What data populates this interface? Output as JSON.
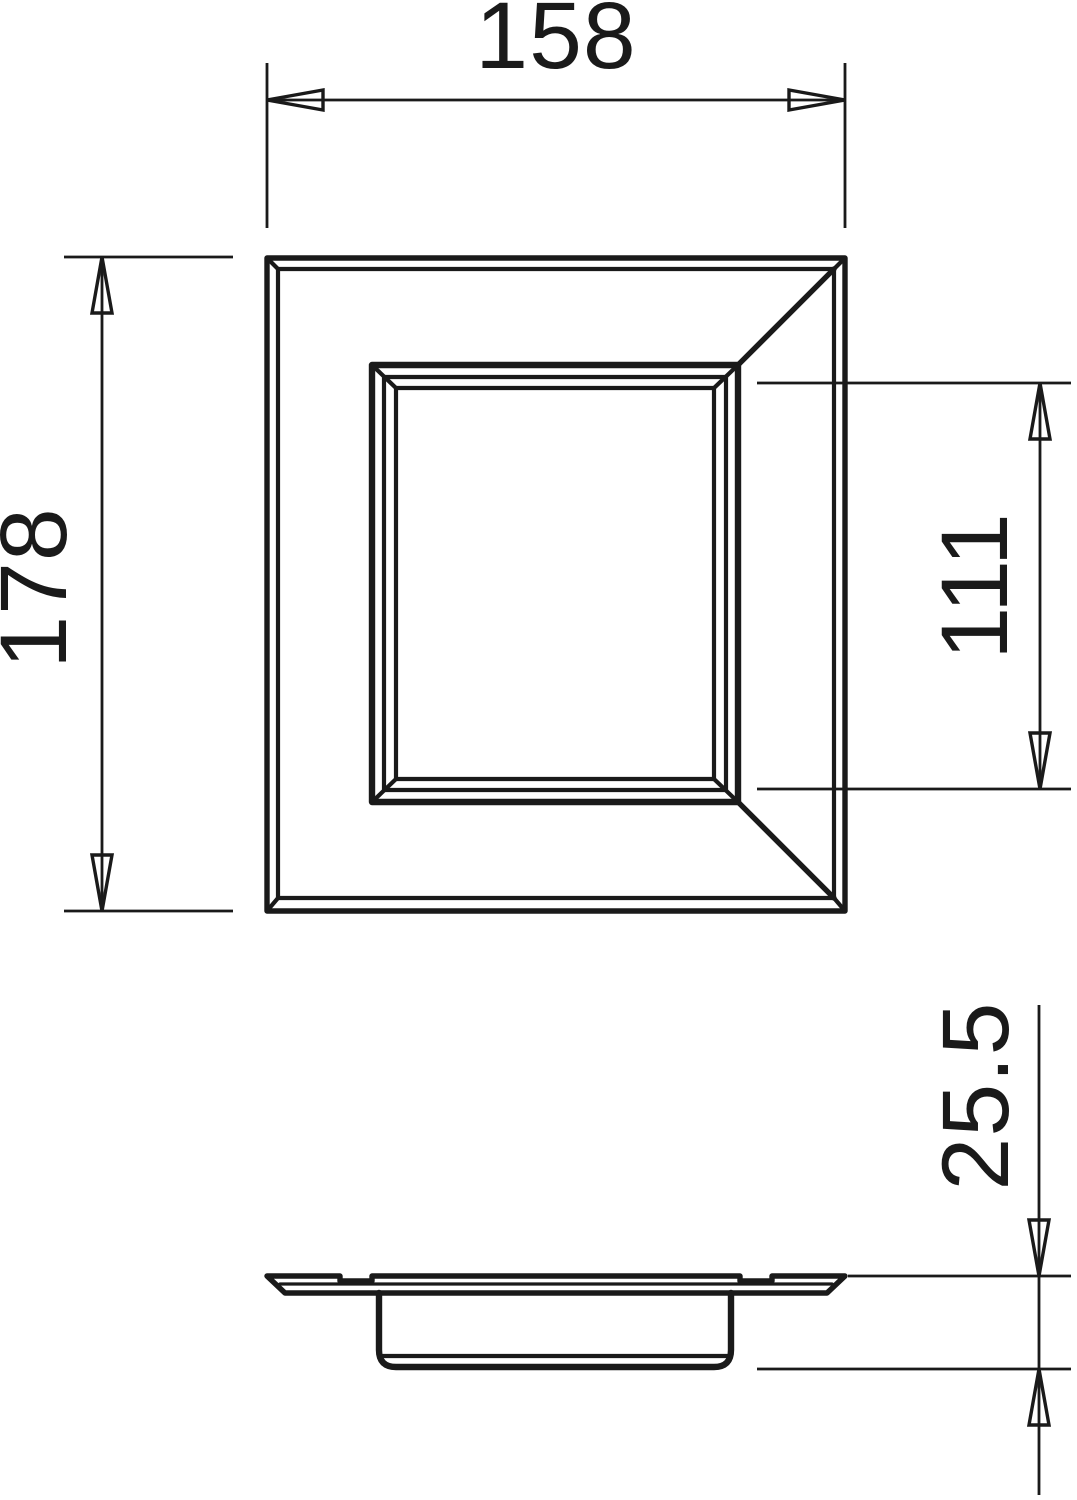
{
  "page": {
    "background": "#ffffff",
    "line_color": "#1a1a1a",
    "type_label": "technical-dimension-drawing"
  },
  "dimensions": {
    "overall_width": {
      "value": "158"
    },
    "overall_height": {
      "value": "178"
    },
    "opening_height": {
      "value": "111"
    },
    "overall_depth": {
      "value": "25.5"
    }
  }
}
